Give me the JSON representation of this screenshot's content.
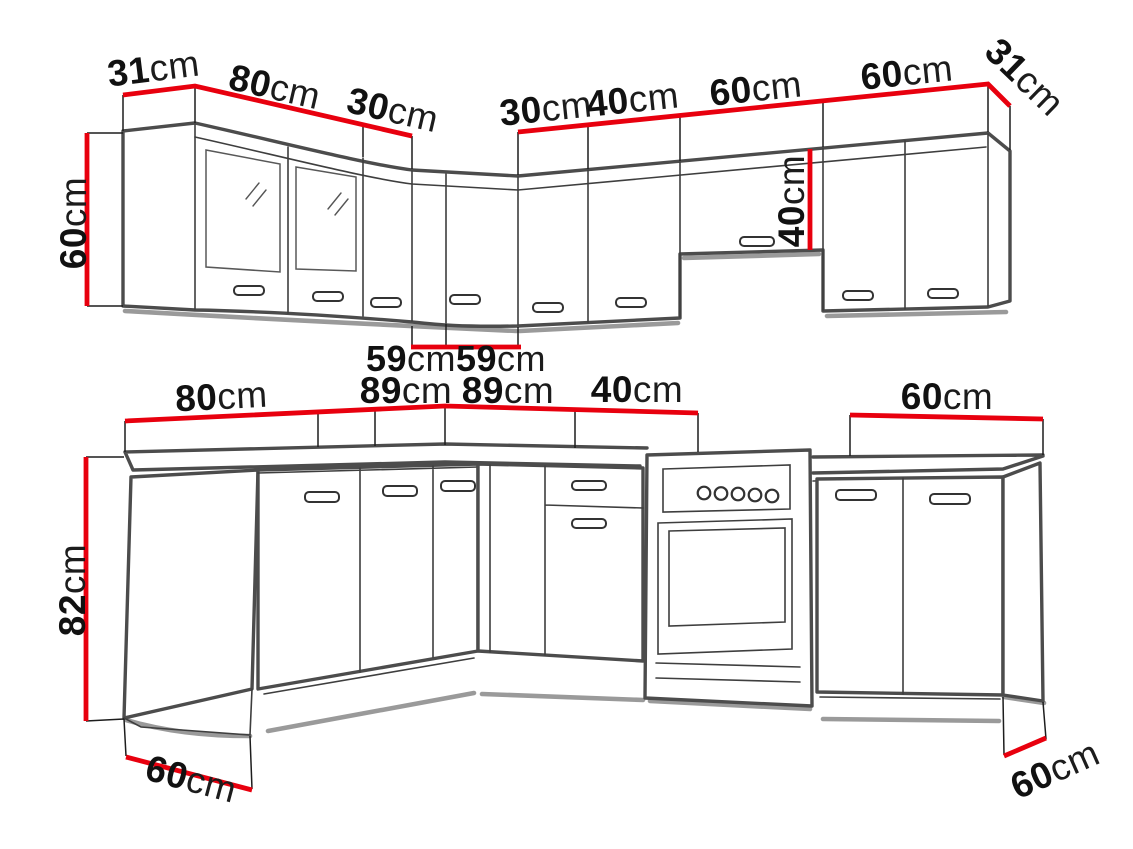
{
  "meta": {
    "description": "Kitchen cabinet set dimension diagram, wall units above and base units below",
    "unit": "cm",
    "colors": {
      "accent": "#e8000e",
      "line": "#4c4c4c",
      "thin": "#3e3e3e",
      "soft": "#9a9a9a",
      "ink": "#111111",
      "bg": "#ffffff"
    }
  },
  "upper": {
    "name": "wall cabinets",
    "top_dims": [
      {
        "value": "31",
        "unit": "cm"
      },
      {
        "value": "80",
        "unit": "cm"
      },
      {
        "value": "30",
        "unit": "cm"
      },
      {
        "value": "30",
        "unit": "cm"
      },
      {
        "value": "40",
        "unit": "cm"
      },
      {
        "value": "60",
        "unit": "cm"
      },
      {
        "value": "60",
        "unit": "cm"
      },
      {
        "value": "31",
        "unit": "cm"
      }
    ],
    "left_height": {
      "value": "60",
      "unit": "cm"
    },
    "mid_height": {
      "value": "40",
      "unit": "cm"
    },
    "bottom_dims": [
      {
        "value": "59",
        "unit": "cm"
      },
      {
        "value": "59",
        "unit": "cm"
      }
    ]
  },
  "lower": {
    "name": "base cabinets",
    "top_dims": [
      {
        "value": "80",
        "unit": "cm"
      },
      {
        "value": "89",
        "unit": "cm"
      },
      {
        "value": "89",
        "unit": "cm"
      },
      {
        "value": "40",
        "unit": "cm"
      },
      {
        "value": "60",
        "unit": "cm"
      }
    ],
    "left_height": {
      "value": "82",
      "unit": "cm"
    },
    "left_depth": {
      "value": "60",
      "unit": "cm"
    },
    "right_depth": {
      "value": "60",
      "unit": "cm"
    }
  }
}
